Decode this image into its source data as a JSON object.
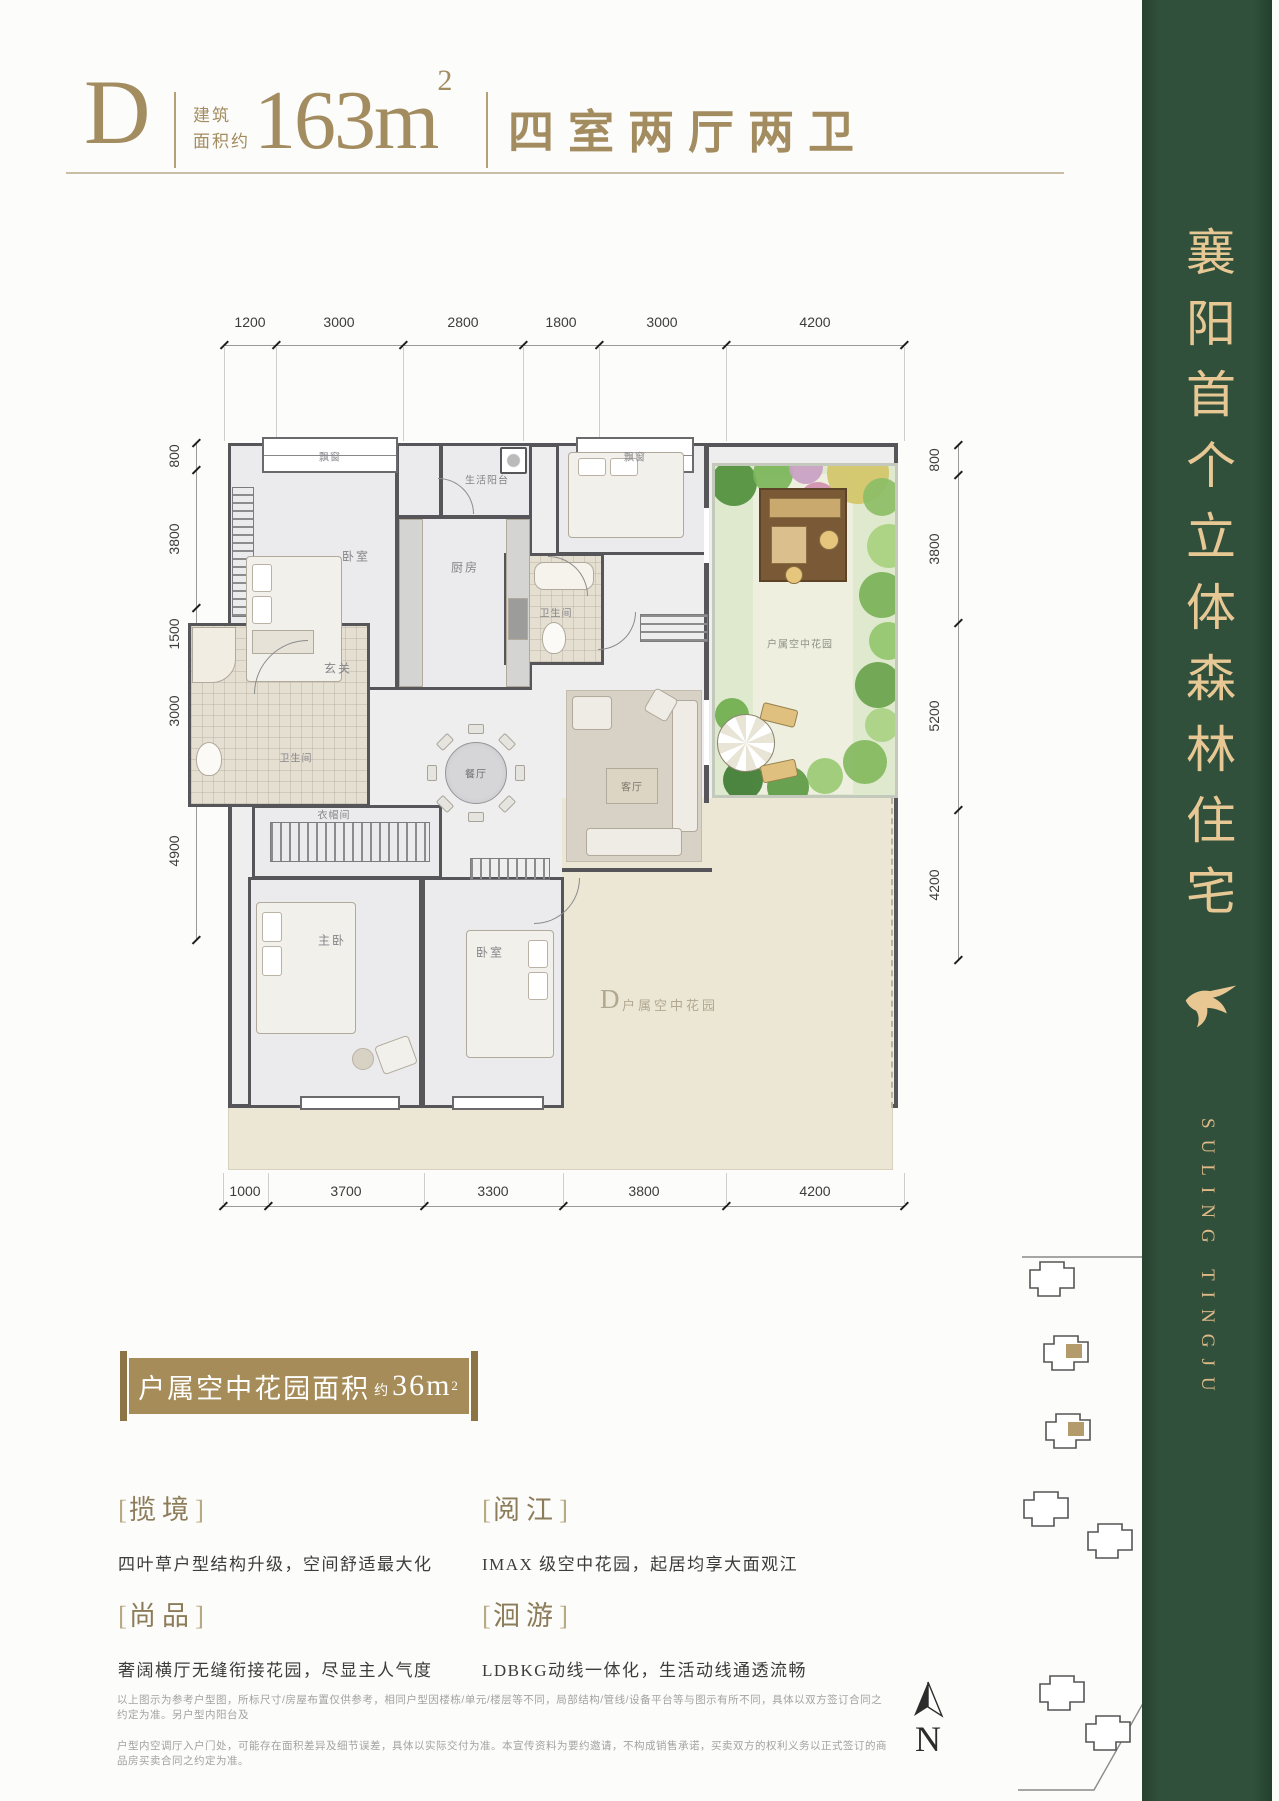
{
  "header": {
    "unit": "D",
    "area_label_1": "建筑",
    "area_label_2": "面积约",
    "area_value": "163m",
    "area_sup": "2",
    "layout": "四室两厅两卫"
  },
  "banner": {
    "slogan": "襄阳首个立体森林住宅",
    "brand_en": "SULING TINGJU",
    "green": "#2e4b38",
    "gold": "#e7c894",
    "bird_icon": "swallow-icon"
  },
  "floorplan": {
    "dims_top": [
      "1200",
      "3000",
      "2800",
      "1800",
      "3000",
      "4200"
    ],
    "dims_bottom": [
      "1000",
      "3700",
      "3300",
      "3800",
      "4200"
    ],
    "dims_left": [
      "800",
      "3800",
      "1500",
      "3000",
      "4900"
    ],
    "dims_right": [
      "800",
      "3800",
      "5200",
      "4200"
    ],
    "labels": {
      "bay1": "飘窗",
      "bay2": "飘窗",
      "bedroom_top": "卧室",
      "balcony": "生活阳台",
      "kitchen": "厨房",
      "bath_top": "卫生间",
      "foyer": "玄关",
      "dining": "餐厅",
      "living": "客厅",
      "bath_left": "卫生间",
      "cloak": "衣帽间",
      "master": "主卧",
      "bedroom_bottom": "卧室",
      "garden": "户属空中花园",
      "terrace_d": "D",
      "terrace": "户属空中花园"
    }
  },
  "badge": {
    "text": "户属空中花园面积",
    "approx": "约",
    "value": "36m",
    "sup": "2"
  },
  "punct": {
    "bl": "[",
    "br": "]"
  },
  "features": [
    {
      "title": "揽境",
      "desc": "四叶草户型结构升级，空间舒适最大化"
    },
    {
      "title": "阅江",
      "desc": "IMAX 级空中花园，起居均享大面观江"
    },
    {
      "title": "尚品",
      "desc": "奢阔横厅无缝衔接花园，尽显主人气度"
    },
    {
      "title": "洄游",
      "desc": "LDBKG动线一体化，生活动线通透流畅"
    }
  ],
  "disclaimer": {
    "line1": "以上图示为参考户型图，所标尺寸/房屋布置仅供参考，相同户型因楼栋/单元/楼层等不同，局部结构/管线/设备平台等与图示有所不同，具体以双方签订合同之约定为准。另户型内阳台及",
    "line2": "户型内空调厅入户门处，可能存在面积差异及细节误差，具体以实际交付为准。本宣传资料为要约邀请，不构成销售承诺，买卖双方的权利义务以正式签订的商品房买卖合同之约定为准。"
  },
  "sitemap": {
    "north": "N"
  }
}
